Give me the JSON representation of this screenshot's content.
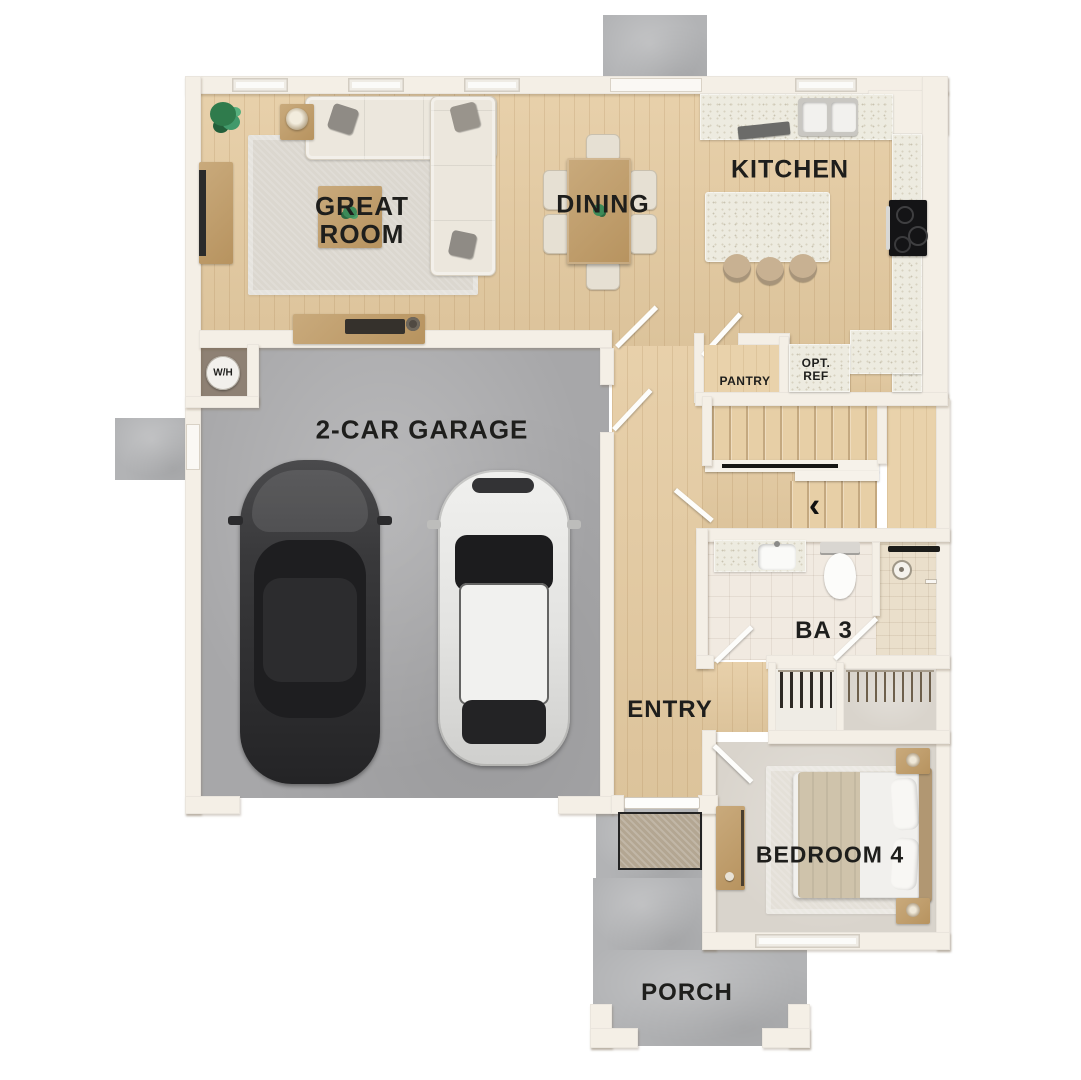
{
  "floorplan": {
    "rooms": {
      "great_room": "GREAT ROOM",
      "dining": "DINING",
      "kitchen": "KITCHEN",
      "garage": "2-CAR GARAGE",
      "pantry": "PANTRY",
      "opt_ref": "OPT. REF",
      "water_heater": "W/H",
      "bath3": "BA 3",
      "entry": "ENTRY",
      "bedroom4": "BEDROOM 4",
      "porch": "PORCH"
    },
    "stairs": {
      "direction_arrow": "‹"
    },
    "colors": {
      "background": "#ffffff",
      "wall": "#f4efe6",
      "wood_floor": "#e5cba1",
      "garage_floor": "#a7a7a9",
      "porch_concrete": "#b2b3b5",
      "bedroom_carpet": "#d9d4cc",
      "bath_tile": "#f1eae1",
      "shower_tile": "#eadfcb",
      "counter_granite": "#edebe0",
      "label_text": "#1e1e1c",
      "dark_car": "#353537",
      "light_car": "#e9e9e7"
    }
  }
}
